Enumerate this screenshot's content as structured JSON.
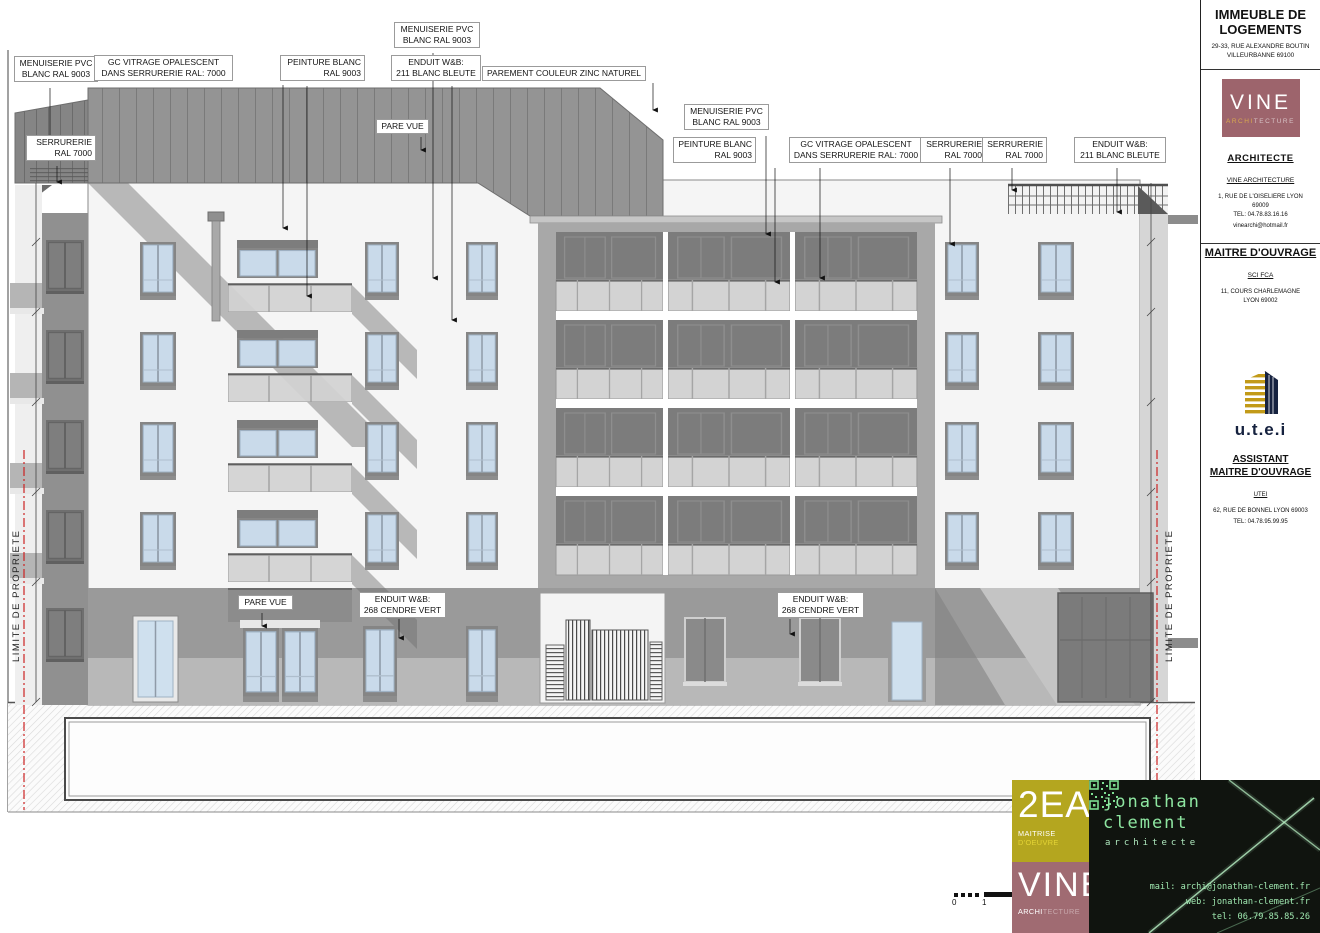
{
  "annotations": [
    {
      "text": "MENUISERIE PVC\nBLANC RAL 9003"
    },
    {
      "text": "GC VITRAGE OPALESCENT\nDANS SERRURERIE RAL: 7000"
    },
    {
      "text": "PEINTURE BLANC\nRAL 9003"
    },
    {
      "text": "MENUISERIE PVC\nBLANC RAL 9003"
    },
    {
      "text": "ENDUIT W&B:\n211 BLANC BLEUTE"
    },
    {
      "text": "PAREMENT COULEUR ZINC NATUREL"
    },
    {
      "text": "SERRURERIE\nRAL 7000"
    },
    {
      "text": "PARE VUE"
    },
    {
      "text": "MENUISERIE PVC\nBLANC RAL 9003"
    },
    {
      "text": "PEINTURE BLANC\nRAL 9003"
    },
    {
      "text": "GC VITRAGE OPALESCENT\nDANS SERRURERIE RAL: 7000"
    },
    {
      "text": "SERRURERIE\nRAL 7000"
    },
    {
      "text": "SERRURERIE\nRAL 7000"
    },
    {
      "text": "ENDUIT W&B:\n211 BLANC BLEUTE"
    },
    {
      "text": "PARE VUE"
    },
    {
      "text": "ENDUIT W&B:\n268 CENDRE VERT"
    },
    {
      "text": "ENDUIT W&B:\n268 CENDRE VERT"
    }
  ],
  "property_line_label": "LIMITE DE PROPRIETE",
  "scale_bar": {
    "start": "0",
    "end": "1"
  },
  "title_block": {
    "project_title": "IMMEUBLE DE\nLOGEMENTS",
    "project_address": "29-33, RUE ALEXANDRE BOUTIN\nVILLEURBANNE 69100",
    "vine_logo": {
      "name": "VINE",
      "sub_accent": "ARCHI",
      "sub_rest": "TECTURE"
    },
    "architect": {
      "heading": "ARCHITECTE",
      "firm": "VINE ARCHITECTURE",
      "address": "1, RUE DE L'OISELIERE LYON\n69009\nTEL: 04.78.83.16.16",
      "email": "vinearchi@hotmail.fr"
    },
    "owner": {
      "heading": "MAITRE D'OUVRAGE",
      "name": "SCI FCA",
      "address": "11, COURS CHARLEMAGNE\nLYON 69002"
    },
    "assistant": {
      "logo_text": "u.t.e.i",
      "heading": "ASSISTANT\nMAITRE D'OUVRAGE",
      "name": "UTEI",
      "address": "62, RUE DE BONNEL LYON 69003",
      "tel": "TEL: 04.78.95.99.95"
    }
  },
  "brand": {
    "ea2": {
      "name": "2EA",
      "sub_white": "MAITRISE ",
      "sub_accent": "D'OEUVRE"
    },
    "vine": {
      "name": "VINE",
      "sub_accent": "ARCHI",
      "sub_rest": "TECTURE"
    },
    "card": {
      "name": "jonathan\nclement",
      "role": "architecte",
      "mail": "mail: archi@jonathan-clement.fr",
      "web": "web: jonathan-clement.fr",
      "tel": "tel: 06.79.85.85.26"
    }
  },
  "colors": {
    "zinc_gray": "#949494",
    "glass_blue": "#c9daea",
    "vine_maroon": "#9d646c",
    "ea_olive": "#b4a61f",
    "card_green": "#8ee6a1",
    "property_line_red": "#cc2222"
  }
}
